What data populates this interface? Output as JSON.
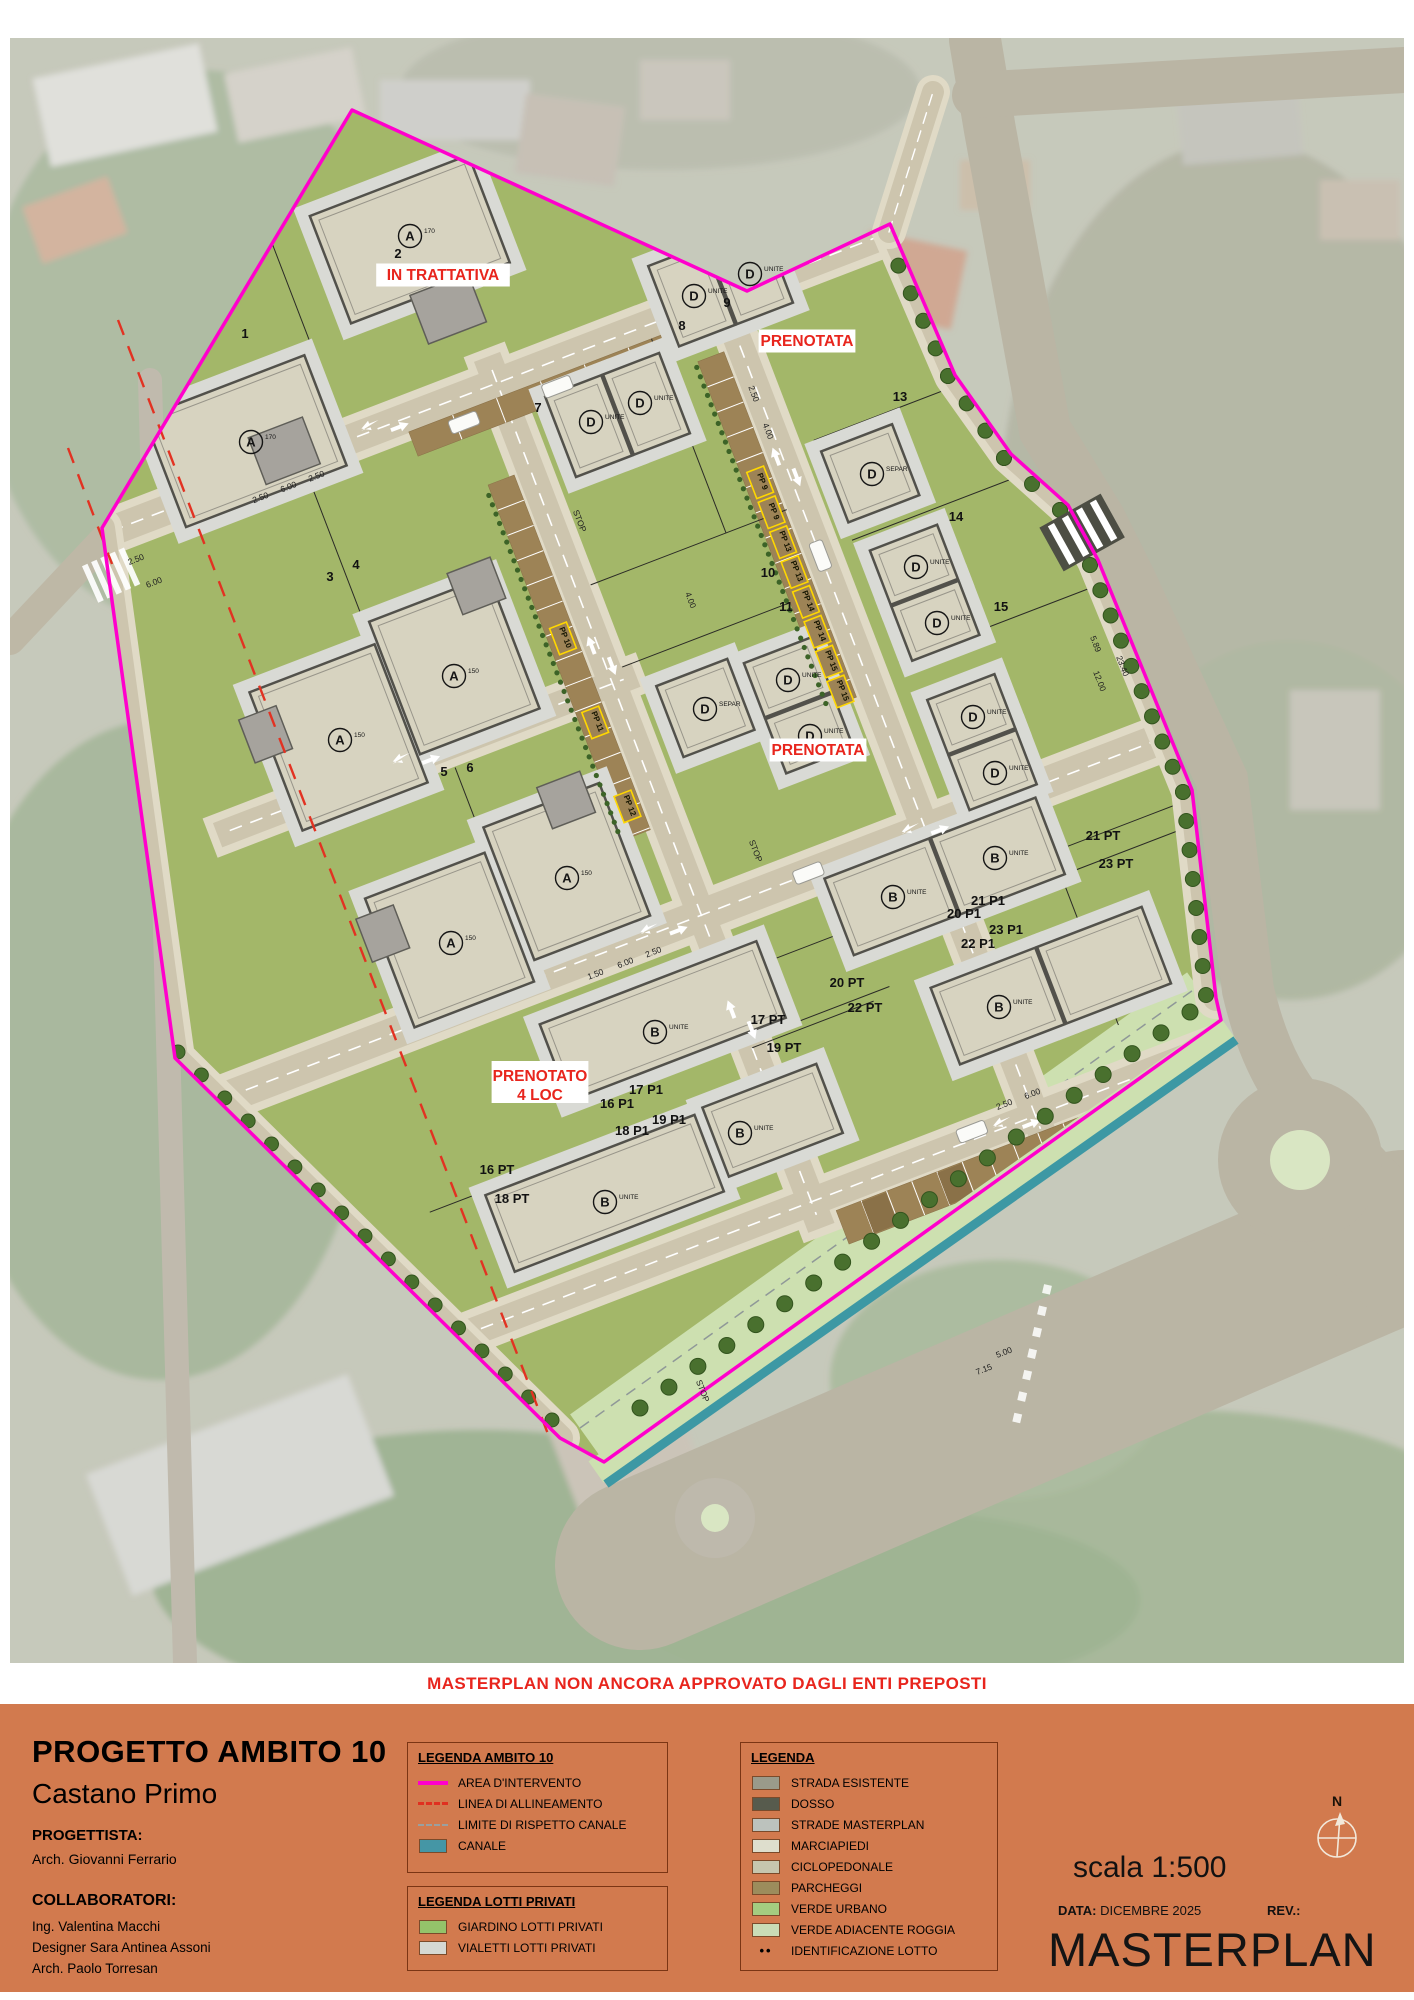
{
  "banner": {
    "text": "MASTERPLAN NON ANCORA APPROVATO DAGLI ENTI PREPOSTI"
  },
  "titleblock": {
    "project_title": "PROGETTO AMBITO 10",
    "city": "Castano Primo",
    "progettista_label": "PROGETTISTA:",
    "progettista": "Arch. Giovanni Ferrario",
    "collaboratori_label": "COLLABORATORI:",
    "collaboratori": [
      "Ing. Valentina Macchi",
      "Designer Sara Antinea Assoni",
      "Arch. Paolo Torresan"
    ]
  },
  "legend_ambito": {
    "title": "LEGENDA AMBITO 10",
    "items": [
      {
        "label": "AREA D'INTERVENTO",
        "swatch": "magenta-line",
        "color": "#ff00cc"
      },
      {
        "label": "LINEA DI ALLINEAMENTO",
        "swatch": "red-dash",
        "color": "#e03020"
      },
      {
        "label": "LIMITE DI RISPETTO CANALE",
        "swatch": "gray-dash",
        "color": "#9aa0a0"
      },
      {
        "label": "CANALE",
        "swatch": "rect",
        "color": "#4596a5"
      }
    ]
  },
  "legend_lotti": {
    "title": "LEGENDA LOTTI PRIVATI",
    "items": [
      {
        "label": "GIARDINO LOTTI PRIVATI",
        "swatch": "rect",
        "color": "#94c36a"
      },
      {
        "label": "VIALETTI LOTTI PRIVATI",
        "swatch": "rect",
        "color": "#d5d8d3"
      }
    ]
  },
  "legend_main": {
    "title": "LEGENDA",
    "items": [
      {
        "label": "STRADA ESISTENTE",
        "swatch": "rect",
        "color": "#9a9a8a"
      },
      {
        "label": "DOSSO",
        "swatch": "rect",
        "color": "#575b4d"
      },
      {
        "label": "STRADE MASTERPLAN",
        "swatch": "rect",
        "color": "#bcc2bd"
      },
      {
        "label": "MARCIAPIEDI",
        "swatch": "rect",
        "color": "#dedecd"
      },
      {
        "label": "CICLOPEDONALE",
        "swatch": "rect",
        "color": "#c6c6ae"
      },
      {
        "label": "PARCHEGGI",
        "swatch": "rect",
        "color": "#9c8c5c"
      },
      {
        "label": "VERDE URBANO",
        "swatch": "rect",
        "color": "#a4cc80"
      },
      {
        "label": "VERDE ADIACENTE ROGGIA",
        "swatch": "rect",
        "color": "#cadcb6"
      },
      {
        "label": "IDENTIFICAZIONE LOTTO",
        "swatch": "dots",
        "color": "#111111"
      }
    ]
  },
  "footer": {
    "scala": "scala 1:500",
    "data_label": "DATA:",
    "data_value": "DICEMBRE 2025",
    "rev_label": "REV.:",
    "doc_title": "MASTERPLAN",
    "north_label": "N"
  },
  "map": {
    "colors": {
      "boundary": "#ff00cc",
      "status_red": "#e8251d",
      "site_green": "#a3b769",
      "canal": "#3d98a4",
      "roggia": "#cde0b0",
      "road": "#cdc5ae",
      "sidewalk": "#e0dac6",
      "parking": "#9d8356",
      "tree": "#49702e"
    },
    "status_labels": [
      {
        "text": "IN TRATTATIVA",
        "x": 443,
        "y": 280
      },
      {
        "text": "PRENOTATA",
        "x": 807,
        "y": 346
      },
      {
        "text": "PRENOTATA",
        "x": 818,
        "y": 755
      },
      {
        "text": "PRENOTATO",
        "text2": "4 LOC",
        "x": 540,
        "y": 1087
      }
    ],
    "lot_numbers": [
      {
        "t": "1",
        "x": 245,
        "y": 338
      },
      {
        "t": "2",
        "x": 398,
        "y": 258
      },
      {
        "t": "3",
        "x": 330,
        "y": 581
      },
      {
        "t": "4",
        "x": 356,
        "y": 569
      },
      {
        "t": "5",
        "x": 444,
        "y": 776
      },
      {
        "t": "6",
        "x": 470,
        "y": 772
      },
      {
        "t": "7",
        "x": 538,
        "y": 412
      },
      {
        "t": "8",
        "x": 682,
        "y": 330
      },
      {
        "t": "9",
        "x": 727,
        "y": 307
      },
      {
        "t": "10",
        "x": 768,
        "y": 577
      },
      {
        "t": "11",
        "x": 786,
        "y": 611
      },
      {
        "t": "13",
        "x": 900,
        "y": 401
      },
      {
        "t": "14",
        "x": 956,
        "y": 521
      },
      {
        "t": "15",
        "x": 1001,
        "y": 611
      },
      {
        "t": "21 PT",
        "x": 1103,
        "y": 840
      },
      {
        "t": "23 PT",
        "x": 1116,
        "y": 868
      },
      {
        "t": "21 P1",
        "x": 988,
        "y": 905
      },
      {
        "t": "23 P1",
        "x": 1006,
        "y": 934
      },
      {
        "t": "20 P1",
        "x": 964,
        "y": 918
      },
      {
        "t": "22 P1",
        "x": 978,
        "y": 948
      },
      {
        "t": "20 PT",
        "x": 847,
        "y": 987
      },
      {
        "t": "22 PT",
        "x": 865,
        "y": 1012
      },
      {
        "t": "17 PT",
        "x": 768,
        "y": 1024
      },
      {
        "t": "19 PT",
        "x": 784,
        "y": 1052
      },
      {
        "t": "16 P1",
        "x": 617,
        "y": 1108
      },
      {
        "t": "17 P1",
        "x": 646,
        "y": 1094
      },
      {
        "t": "18 P1",
        "x": 632,
        "y": 1135
      },
      {
        "t": "19 P1",
        "x": 669,
        "y": 1124
      },
      {
        "t": "16 PT",
        "x": 497,
        "y": 1174
      },
      {
        "t": "18 PT",
        "x": 512,
        "y": 1203
      }
    ],
    "building_labels": [
      {
        "l": "A",
        "s": "170",
        "x": 410,
        "y": 236
      },
      {
        "l": "A",
        "s": "170",
        "x": 251,
        "y": 442
      },
      {
        "l": "A",
        "s": "150",
        "x": 340,
        "y": 740
      },
      {
        "l": "A",
        "s": "150",
        "x": 454,
        "y": 676
      },
      {
        "l": "A",
        "s": "150",
        "x": 451,
        "y": 943
      },
      {
        "l": "A",
        "s": "150",
        "x": 567,
        "y": 878
      },
      {
        "l": "D",
        "s": "UNITE",
        "x": 591,
        "y": 422
      },
      {
        "l": "D",
        "s": "UNITE",
        "x": 640,
        "y": 403
      },
      {
        "l": "D",
        "s": "UNITE",
        "x": 694,
        "y": 296
      },
      {
        "l": "D",
        "s": "UNITE",
        "x": 750,
        "y": 274
      },
      {
        "l": "D",
        "s": "SEPAR",
        "x": 705,
        "y": 709
      },
      {
        "l": "D",
        "s": "SEPAR",
        "x": 872,
        "y": 474
      },
      {
        "l": "D",
        "s": "UNITE",
        "x": 788,
        "y": 680
      },
      {
        "l": "D",
        "s": "UNITE",
        "x": 810,
        "y": 736
      },
      {
        "l": "D",
        "s": "UNITE",
        "x": 916,
        "y": 567
      },
      {
        "l": "D",
        "s": "UNITE",
        "x": 937,
        "y": 623
      },
      {
        "l": "D",
        "s": "UNITE",
        "x": 973,
        "y": 717
      },
      {
        "l": "D",
        "s": "UNITE",
        "x": 995,
        "y": 773
      },
      {
        "l": "B",
        "s": "UNITE",
        "x": 655,
        "y": 1032
      },
      {
        "l": "B",
        "s": "UNITE",
        "x": 605,
        "y": 1202
      },
      {
        "l": "B",
        "s": "UNITE",
        "x": 740,
        "y": 1133
      },
      {
        "l": "B",
        "s": "UNITE",
        "x": 893,
        "y": 897
      },
      {
        "l": "B",
        "s": "UNITE",
        "x": 995,
        "y": 858
      },
      {
        "l": "B",
        "s": "UNITE",
        "x": 999,
        "y": 1007
      }
    ],
    "pp_labels": [
      {
        "n": "9",
        "x": 870,
        "y": 525
      },
      {
        "n": "9",
        "x": 870,
        "y": 557
      },
      {
        "n": "13",
        "x": 870,
        "y": 589
      },
      {
        "n": "13",
        "x": 870,
        "y": 621
      },
      {
        "n": "14",
        "x": 870,
        "y": 653
      },
      {
        "n": "14",
        "x": 870,
        "y": 685
      },
      {
        "n": "15",
        "x": 870,
        "y": 717
      },
      {
        "n": "15",
        "x": 870,
        "y": 749
      },
      {
        "n": "10",
        "x": 630,
        "y": 600
      },
      {
        "n": "11",
        "x": 630,
        "y": 690
      },
      {
        "n": "12",
        "x": 630,
        "y": 780
      }
    ],
    "dims_grid": [
      {
        "t": "2.50",
        "x": 398,
        "y": 363,
        "r": 0
      },
      {
        "t": "6.00",
        "x": 428,
        "y": 363,
        "r": 0
      },
      {
        "t": "2.50",
        "x": 458,
        "y": 363,
        "r": 0
      },
      {
        "t": "1.50",
        "x": 540,
        "y": 928,
        "r": 0
      },
      {
        "t": "6.00",
        "x": 572,
        "y": 928,
        "r": 0
      },
      {
        "t": "2.50",
        "x": 602,
        "y": 928,
        "r": 0
      },
      {
        "t": "4.00",
        "x": 893,
        "y": 480,
        "r": 90
      },
      {
        "t": "2.50",
        "x": 893,
        "y": 440,
        "r": 90
      },
      {
        "t": "4.00",
        "x": 760,
        "y": 610,
        "r": 90
      },
      {
        "t": "8.65",
        "x": 985,
        "y": 1258,
        "r": 0
      },
      {
        "t": "6.00",
        "x": 905,
        "y": 1196,
        "r": 0
      },
      {
        "t": "2.50",
        "x": 875,
        "y": 1196,
        "r": 0
      }
    ],
    "dims_base": [
      {
        "t": "5.89",
        "x": 1093,
        "y": 645,
        "r": 69
      },
      {
        "t": "12.00",
        "x": 1097,
        "y": 682,
        "r": 69
      },
      {
        "t": "23.40",
        "x": 1120,
        "y": 667,
        "r": 69
      },
      {
        "t": "2.50",
        "x": 137,
        "y": 562,
        "r": -21
      },
      {
        "t": "6.00",
        "x": 155,
        "y": 585,
        "r": -21
      },
      {
        "t": "5.00",
        "x": 1005,
        "y": 1355,
        "r": -21
      },
      {
        "t": "7.15",
        "x": 985,
        "y": 1372,
        "r": -21
      },
      {
        "t": "STOP",
        "x": 577,
        "y": 522,
        "r": 69
      },
      {
        "t": "STOP",
        "x": 753,
        "y": 852,
        "r": 69
      },
      {
        "t": "STOP",
        "x": 700,
        "y": 1392,
        "r": 69
      }
    ]
  }
}
